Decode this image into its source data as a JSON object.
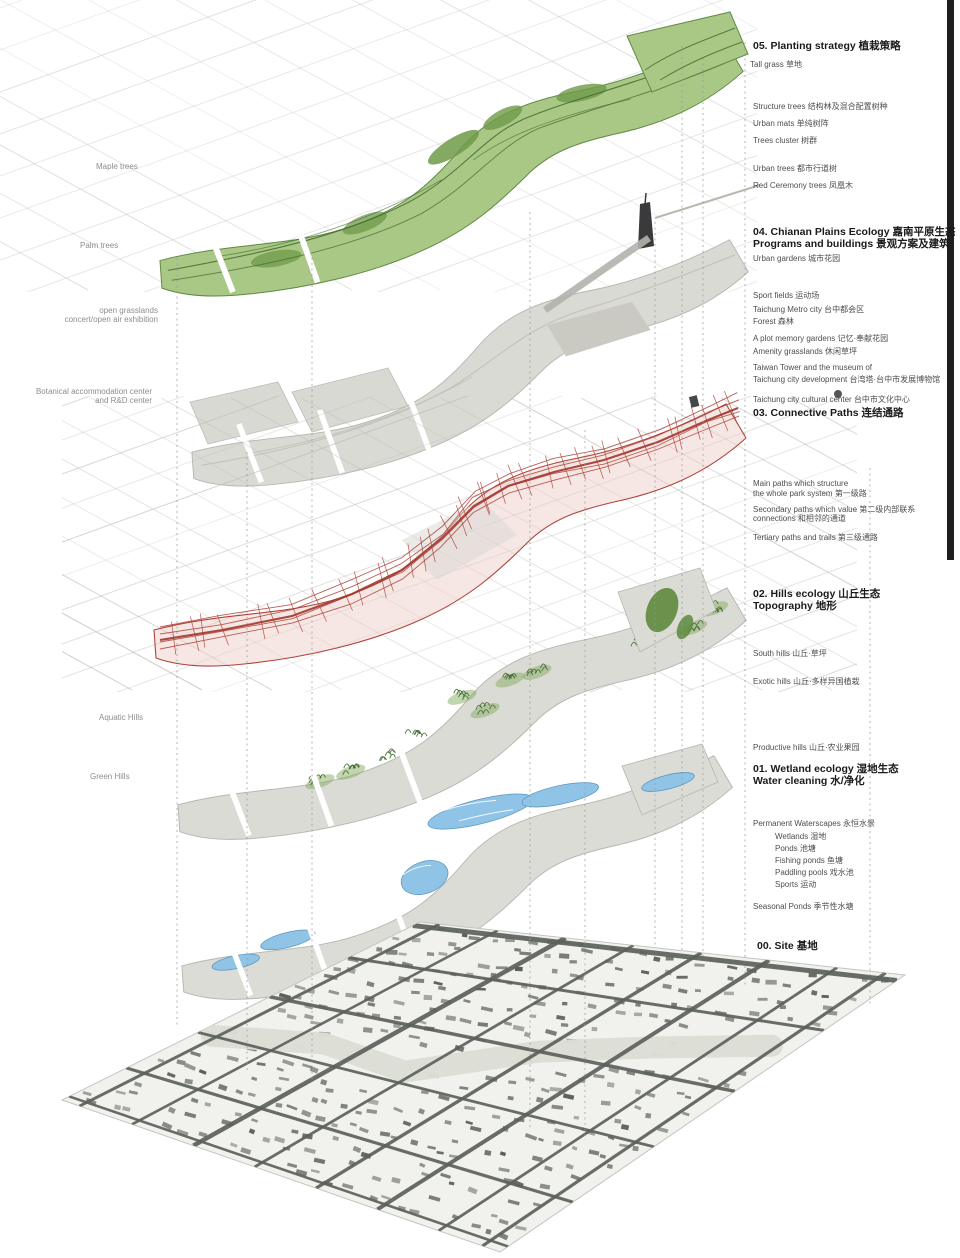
{
  "diagram": {
    "layers": [
      {
        "id": "05",
        "title": "05. Planting strategy 植栽策略",
        "notes": [
          "Tall grass 草地",
          "Structure trees 结构林及混合配置树种",
          "Urban mats 单纯树阵",
          "Trees cluster 树群",
          "Urban trees 都市行道树",
          "Red Ceremony trees 凤凰木"
        ]
      },
      {
        "id": "04",
        "title": "04. Chianan Plains Ecology 嘉南平原生态",
        "subtitle": "Programs and buildings 景观方案及建筑",
        "notes": [
          "Urban gardens 城市花园",
          "Sport fields 运动场",
          "Taichung Metro city 台中都会区",
          "Forest 森林",
          "A plot memory gardens 记忆·奉献花园",
          "Amenity grasslands 休闲草坪",
          "Taiwan Tower and the museum of",
          "Taichung city development 台湾塔·台中市发展博物馆",
          "Taichung city cultural center 台中市文化中心"
        ]
      },
      {
        "id": "03",
        "title": "03. Connective Paths 连结通路",
        "notes": [
          "Main paths which structure",
          "the whole park system 第一级路",
          "Secondary paths which value 第二级内部联系",
          "connections 和相邻的通道",
          "Tertiary paths and trails 第三级通路"
        ]
      },
      {
        "id": "02",
        "title": "02. Hills ecology 山丘生态",
        "subtitle": "Topography 地形",
        "notes": [
          "South hills 山丘·草坪",
          "Exotic hills 山丘·多样异国植栽",
          "Productive hills 山丘·农业果园"
        ]
      },
      {
        "id": "01",
        "title": "01. Wetland ecology 湿地生态",
        "subtitle": "Water cleaning 水/净化",
        "notes": [
          "Permanent Waterscapes 永恒水景",
          "Wetlands 湿地",
          "Ponds 池塘",
          "Fishing ponds 鱼塘",
          "Paddling pools 戏水池",
          "Sports 运动",
          "Seasonal Ponds 季节性水塘"
        ]
      },
      {
        "id": "00",
        "title": "00. Site 基地"
      }
    ],
    "left_labels": {
      "maple_trees": "Maple trees",
      "palm_trees": "Palm trees",
      "grasslands_line1": "open grasslands",
      "grasslands_line2": "concert/open air exhibition",
      "botanical_line1": "Botanical accommodation center",
      "botanical_line2": "and R&D center",
      "aquatic_hills": "Aquatic Hills",
      "green_hills": "Green Hills"
    },
    "colors": {
      "planting_green": "#a9c885",
      "planting_dark": "#41682e",
      "paths_red": "#b0443b",
      "hills_green": "#3f6b2f",
      "water_blue": "#8fc4e6",
      "plane_grey": "#dbdbd5",
      "street_grey": "#c3c8c2",
      "site_dark": "#5d615c",
      "guide_grey": "#979797"
    }
  }
}
